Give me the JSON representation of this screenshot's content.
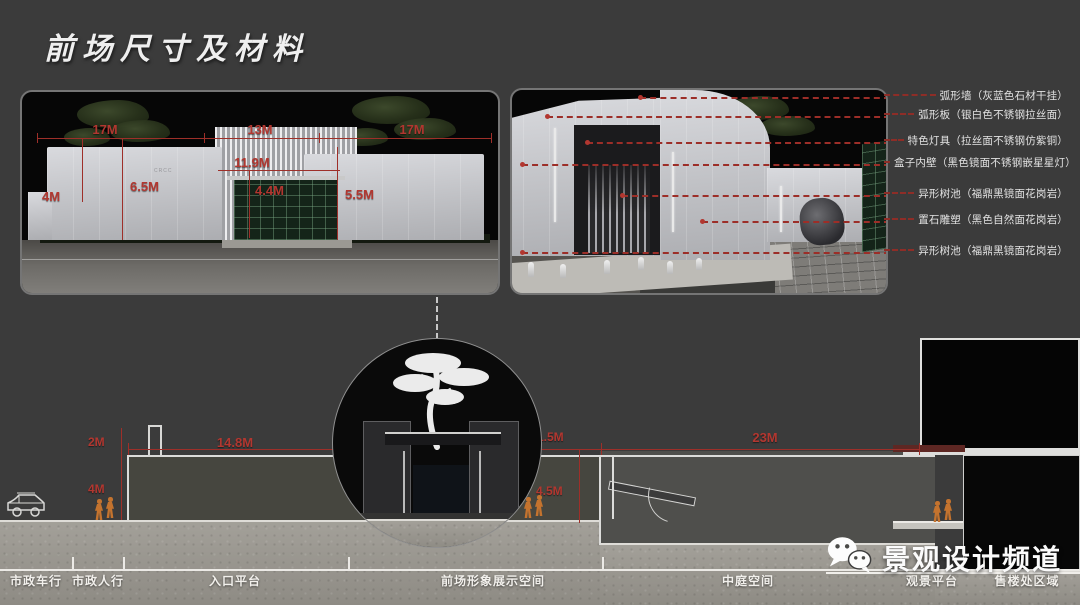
{
  "page": {
    "title": "前场尺寸及材料",
    "colors": {
      "background": "#3b3b3b",
      "dimension_red": "#b23730",
      "annotation_text": "#e2e2e2",
      "ground_concrete": "#98958e",
      "people_orange": "#c4732e"
    },
    "icons": {
      "watermark": "wechat-icon",
      "vehicle": "car-icon",
      "pedestrian": "person-icon",
      "detail_graphic": "pine-tree-calligraphy-icon"
    }
  },
  "left_render": {
    "sign": "CRCC",
    "dims": {
      "top_left": "17M",
      "top_center": "13M",
      "top_right": "17M",
      "left_wall": "4M",
      "mid_wall": "6.5M",
      "gate_width": "11.9M",
      "gate_inner": "4.4M",
      "right_wall": "5.5M"
    }
  },
  "annotations": {
    "items": [
      {
        "label": "弧形墙（灰蓝色石材干挂）"
      },
      {
        "label": "弧形板（银白色不锈钢拉丝面）"
      },
      {
        "label": "特色灯具（拉丝面不锈钢仿紫铜）"
      },
      {
        "label": "盒子内壁（黑色镜面不锈钢嵌星星灯）"
      },
      {
        "label": "异形树池（福鼎黑镜面花岗岩）"
      },
      {
        "label": "置石雕塑（黑色自然面花岗岩）"
      },
      {
        "label": "异形树池（福鼎黑镜面花岗岩）"
      }
    ]
  },
  "section": {
    "dims": {
      "parapet": "2M",
      "plaza_width": "14.8M",
      "wall_height": "4M",
      "gap": "1.5M",
      "court_depth": "4.5M",
      "court_width": "23M"
    },
    "zones": [
      "市政车行",
      "市政人行",
      "入口平台",
      "前场形象展示空间",
      "中庭空间",
      "观景平台",
      "售楼处区域"
    ]
  },
  "watermark": {
    "text": "景观设计频道"
  }
}
